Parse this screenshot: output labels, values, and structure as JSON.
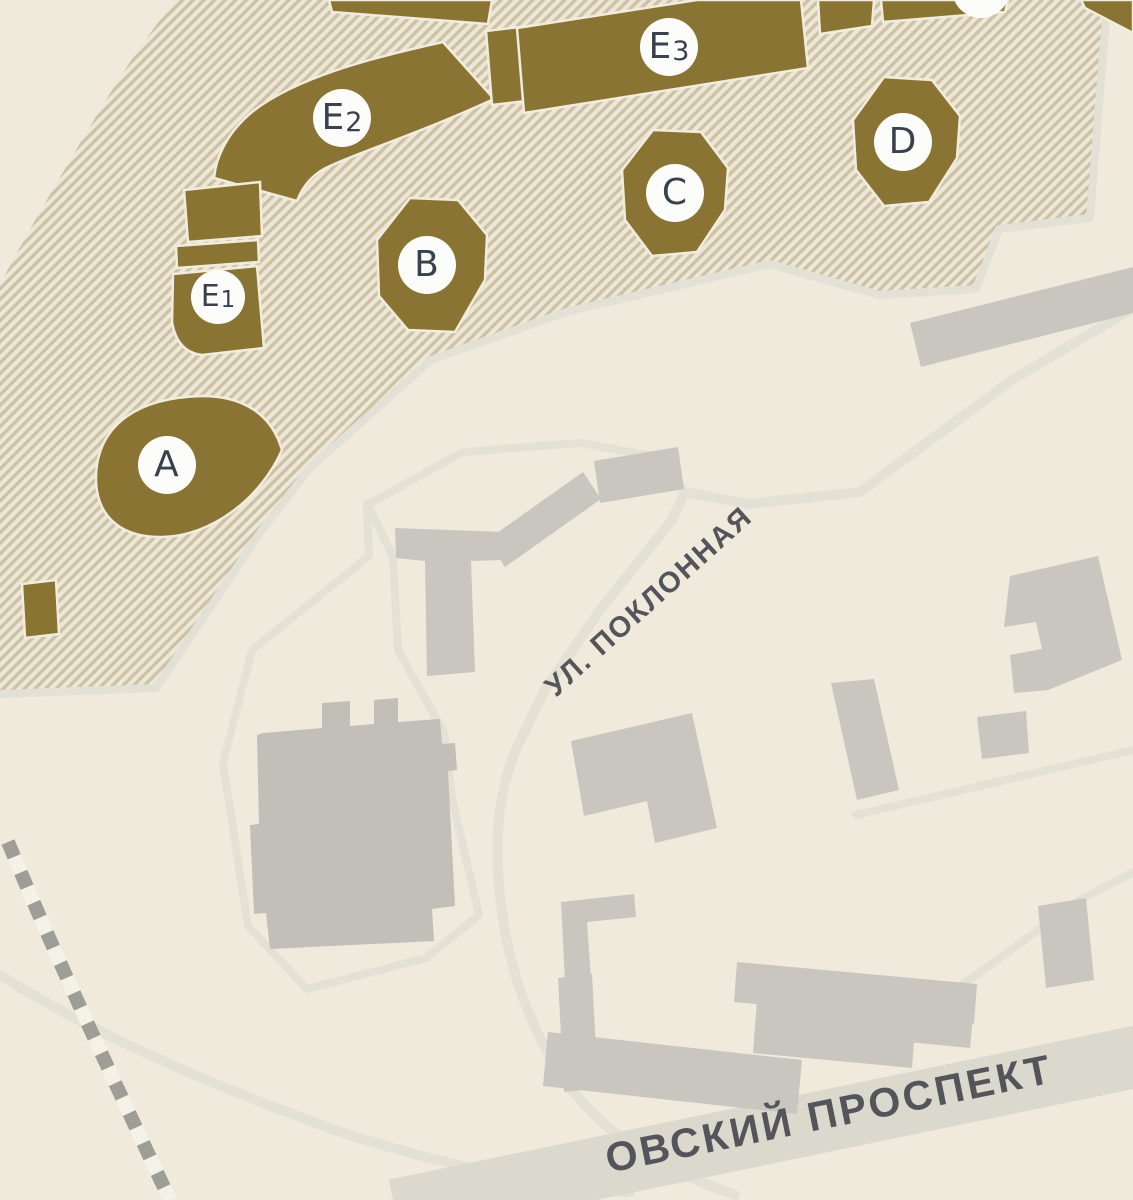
{
  "map": {
    "title": "Site plan with lettered buildings",
    "buildings": [
      {
        "code": "A",
        "main": "A",
        "sub": ""
      },
      {
        "code": "B",
        "main": "B",
        "sub": ""
      },
      {
        "code": "C",
        "main": "C",
        "sub": ""
      },
      {
        "code": "D",
        "main": "D",
        "sub": ""
      },
      {
        "code": "E1",
        "main": "E",
        "sub": "1"
      },
      {
        "code": "E2",
        "main": "E",
        "sub": "2"
      },
      {
        "code": "E3",
        "main": "E",
        "sub": "3"
      }
    ],
    "streets": {
      "poklonnaya": "УЛ. ПОКЛОННАЯ",
      "prospekt": "ОВСКИЙ ПРОСПЕКТ"
    },
    "colors": {
      "page_bg": "#efeadc",
      "hatch_bg": "#ece7d7",
      "hatch_stripe": "#cdc2a6",
      "building_brown": "#8a7434",
      "building_outline": "#f1ecdb",
      "building_gray": "#c9c6c0",
      "building_gray_dark": "#c2bfb9",
      "road": "#e3e0d6",
      "avenue_band": "#dbd8ce",
      "rail_dash": "#9e9d96",
      "rail_casing": "#f4f1e6",
      "marker_bg": "#fcfcfa",
      "marker_text": "#3a414e",
      "street_text": "#54555a"
    }
  }
}
